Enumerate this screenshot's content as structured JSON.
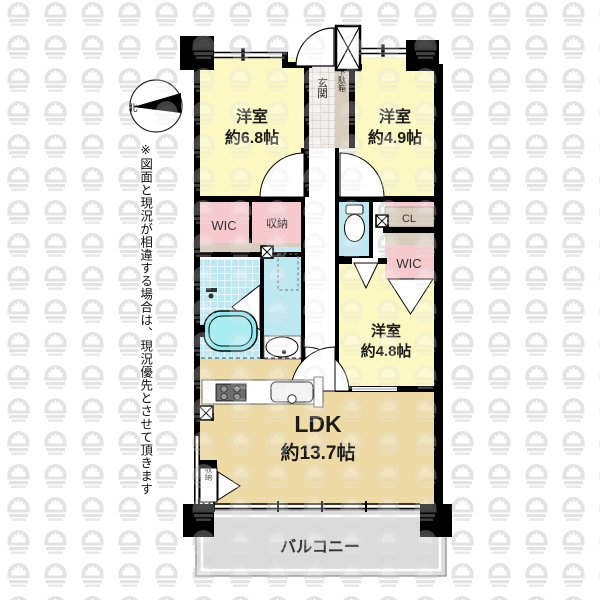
{
  "plan": {
    "rooms": {
      "room_a": {
        "name": "洋室",
        "size": "約6.8帖"
      },
      "room_b": {
        "name": "洋室",
        "size": "約4.9帖"
      },
      "room_c": {
        "name": "洋室",
        "size": "約4.8帖"
      },
      "ldk": {
        "name": "LDK",
        "size": "約13.7帖"
      },
      "balcony": {
        "name": "バルコニー"
      },
      "entrance": {
        "name": "玄関"
      },
      "shoe_box": {
        "name": "下駄箱"
      },
      "wic_left": {
        "name": "WIC"
      },
      "wic_right": {
        "name": "WIC"
      },
      "closet_mid": {
        "name": "収納"
      },
      "closet_ldk": {
        "name": "収納"
      },
      "closet_cl": {
        "name": "CL"
      }
    },
    "compass": {
      "north": "北"
    },
    "disclaimer": "※図面と現況が相違する場合は、現況優先とさせて頂きます",
    "colors": {
      "room_yellow": "#FBF8C2",
      "ldk_tan": "#EDDAA4",
      "closet_pink": "#F6C9CC",
      "wet_cyan": "#BCE8F2",
      "tub_cyan": "#8FE9EF",
      "furniture_tan": "#D8CCBC",
      "balcony_gray": "#DBDBDB",
      "wall_black": "#000000",
      "watermark_gray": "#E2E2E2"
    }
  }
}
